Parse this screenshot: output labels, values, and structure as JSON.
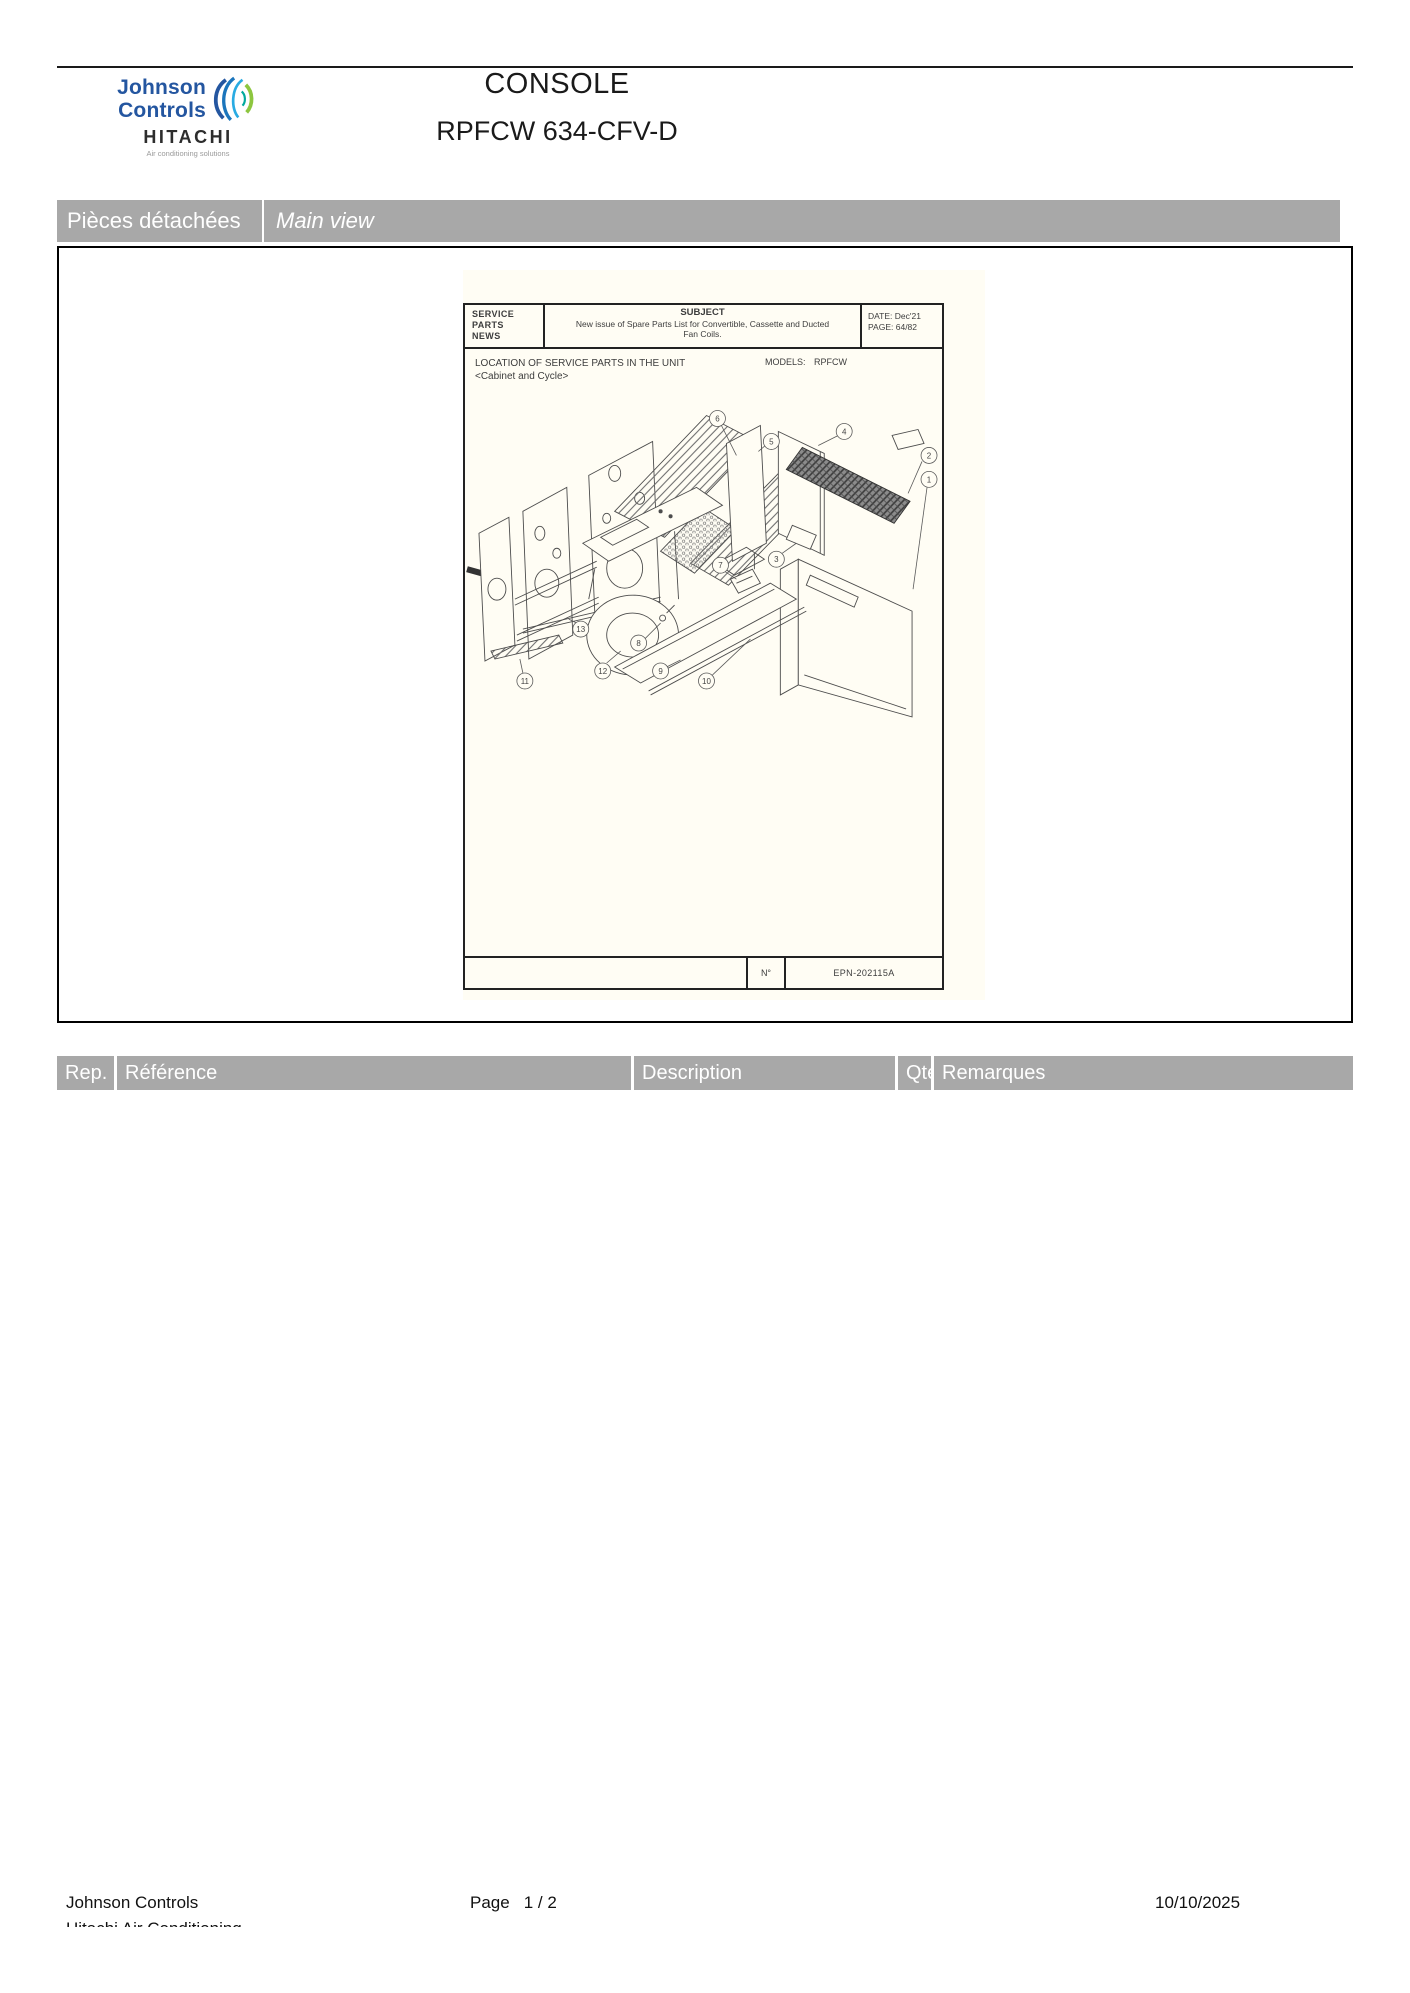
{
  "colors": {
    "bar_gray": "#a8a8a8",
    "jc_blue": "#2456a0",
    "page_cream": "#fffdf4",
    "text_black": "#1a1a1a"
  },
  "header": {
    "logo": {
      "line1": "Johnson",
      "line2": "Controls",
      "brand": "HITACHI",
      "tagline": "Air conditioning solutions"
    },
    "title": "CONSOLE",
    "subtitle": "RPFCW 634-CFV-D"
  },
  "section_bar": {
    "left": "Pièces détachées",
    "right": "Main view"
  },
  "doc": {
    "spn": [
      "SERVICE",
      "PARTS",
      "NEWS"
    ],
    "subject_label": "SUBJECT",
    "subject_line1": "New issue of Spare Parts List for Convertible, Cassette and Ducted",
    "subject_line2": "Fan Coils.",
    "date_label": "DATE:",
    "date_value": "Dec'21",
    "page_label": "PAGE:",
    "page_value": "64/82",
    "location_line1": "LOCATION OF SERVICE PARTS IN THE UNIT",
    "location_line2": "<Cabinet and Cycle>",
    "models_label": "MODELS:",
    "models_value": "RPFCW",
    "number_label": "N°",
    "number_value": "EPN-202115A",
    "callouts": [
      "1",
      "2",
      "3",
      "4",
      "5",
      "6",
      "7",
      "8",
      "9",
      "10",
      "11",
      "12",
      "13"
    ]
  },
  "table": {
    "headers": [
      "Rep.",
      "Référence",
      "Description",
      "Qté",
      "Remarques"
    ]
  },
  "footer": {
    "company": "Johnson Controls",
    "company_line2": "Hitachi Air Conditioning",
    "page_label": "Page",
    "page_value": "1  /  2",
    "date": "10/10/2025"
  }
}
